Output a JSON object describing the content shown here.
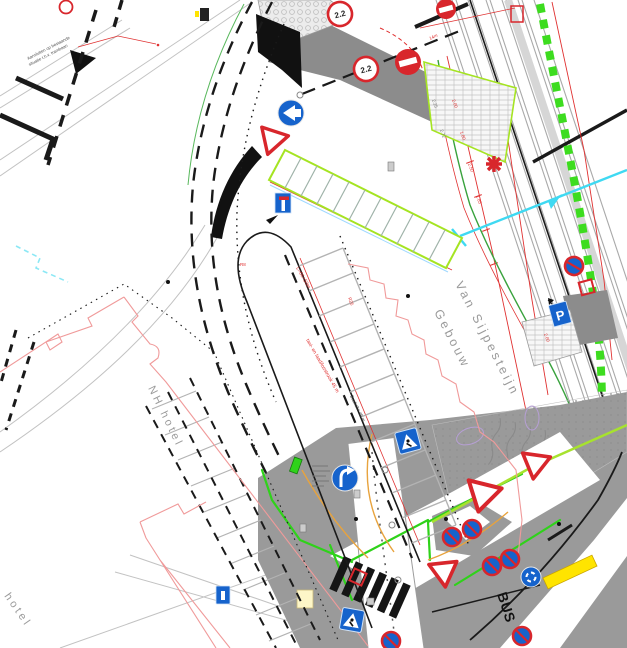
{
  "document_type": "traffic engineering site plan (CAD drawing)",
  "buildings": {
    "nh_hotel": "NH hotel",
    "nh_hotel_partial": "hotel",
    "van_sijpesteijn_line1": "Van Sijpesteijn",
    "van_sijpesteijn_line2": "Gebouw"
  },
  "annotations": {
    "connect_note_line1": "Aansluiten op bestaande",
    "connect_note_line2": "situatie t.h.v. trambaan",
    "red_length_label": "L=66+50m",
    "red_strip_label": "taxi- en laad/losstrook 45 m",
    "bus_stop_label": "Bushalte 45 m",
    "road_marking_bus": "BUS"
  },
  "signs": {
    "width_limit_a": "2.2",
    "width_limit_b": "2.2",
    "parking_letter": "P"
  },
  "dimensions": [
    {
      "text": "2.00"
    },
    {
      "text": "1.80"
    },
    {
      "text": "2.50"
    },
    {
      "text": "1.85"
    },
    {
      "text": "14m"
    },
    {
      "text": "2.25"
    },
    {
      "text": "2.72"
    },
    {
      "text": "R8"
    },
    {
      "text": "R25"
    },
    {
      "text": "2.00"
    }
  ],
  "colors": {
    "sign_red": "#d8262c",
    "sign_blue": "#1663cc",
    "curb_green": "#2fd21a",
    "band_green": "#3ddc1f",
    "cyan": "#3fd9f2",
    "annotation_red": "#e03131",
    "road_gray": "#9a9a9a",
    "building_red": "#f09a9a",
    "marking_yellow": "#ffe400",
    "parking_outline": "#a5e422"
  }
}
